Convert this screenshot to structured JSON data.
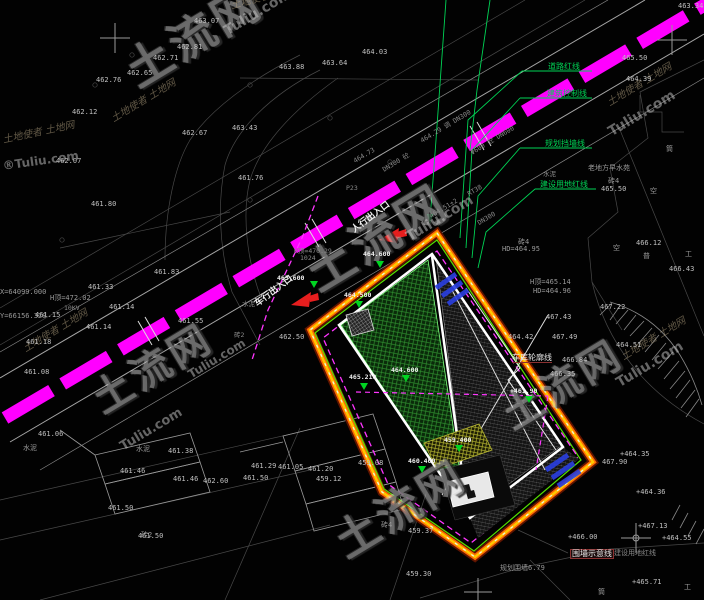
{
  "annotations": {
    "pedestrian_entrance": "人行出入口",
    "vehicle_entrance": "车行出入口",
    "road_red_line": "道路红线",
    "building_control_line": "建筑控制线",
    "planning_wall_line": "规划挡墙线",
    "construction_land_red_line": "建设用地红线",
    "fence_indication_line": "围墙示意线",
    "construction_land_red_line_2": "建设用地红线",
    "garage_outline_line": "车库轮廓线"
  },
  "colors": {
    "road_magenta": "#ff00ff",
    "boundary_glow": "#5f1400",
    "boundary_orange": "#ff6a00",
    "boundary_yellow": "#ffc800",
    "boundary_inner_green": "#55e000",
    "dashed_magenta": "#ff35ff",
    "leader_green": "#00d455",
    "marker_green": "#00d422",
    "arrow_red": "#e61e1e",
    "hatch_green": "#2f8f2f",
    "hatch_gray": "#6a6a6a",
    "hatch_yellow": "#b8b832",
    "blue_mark": "#2a3fe0"
  },
  "green_markers": [
    {
      "t": "463.600",
      "x": 277,
      "y": 274,
      "tx": 310,
      "ty": 281
    },
    {
      "t": "464.600",
      "x": 363,
      "y": 250,
      "tx": 376,
      "ty": 261
    },
    {
      "t": "464.500",
      "x": 344,
      "y": 291,
      "tx": 355,
      "ty": 301
    },
    {
      "t": "465.210",
      "x": 349,
      "y": 373,
      "tx": 360,
      "ty": 383
    },
    {
      "t": "464.600",
      "x": 391,
      "y": 366,
      "tx": 402,
      "ty": 375
    },
    {
      "t": "+461.90",
      "x": 510,
      "y": 387,
      "tx": 525,
      "ty": 396
    },
    {
      "t": "460.400",
      "x": 408,
      "y": 457,
      "tx": 418,
      "ty": 466
    },
    {
      "t": "459.400",
      "x": 444,
      "y": 436,
      "tx": 455,
      "ty": 445
    }
  ],
  "spot_elevations": [
    {
      "t": "463.07",
      "x": 194,
      "y": 17
    },
    {
      "t": "462.81",
      "x": 177,
      "y": 43
    },
    {
      "t": "462.71",
      "x": 153,
      "y": 54
    },
    {
      "t": "462.65",
      "x": 127,
      "y": 69
    },
    {
      "t": "462.76",
      "x": 96,
      "y": 76
    },
    {
      "t": "462.12",
      "x": 72,
      "y": 108
    },
    {
      "t": "462.67",
      "x": 182,
      "y": 129
    },
    {
      "t": "462.07",
      "x": 56,
      "y": 157
    },
    {
      "t": "461.80",
      "x": 91,
      "y": 200
    },
    {
      "t": "464.03",
      "x": 362,
      "y": 48
    },
    {
      "t": "463.64",
      "x": 322,
      "y": 59
    },
    {
      "t": "463.88",
      "x": 279,
      "y": 63
    },
    {
      "t": "463.43",
      "x": 232,
      "y": 124
    },
    {
      "t": "461.76",
      "x": 238,
      "y": 174
    },
    {
      "t": "461.83",
      "x": 154,
      "y": 268
    },
    {
      "t": "461.33",
      "x": 88,
      "y": 283
    },
    {
      "t": "461.14",
      "x": 109,
      "y": 303
    },
    {
      "t": "461.15",
      "x": 35,
      "y": 311
    },
    {
      "t": "461.14",
      "x": 86,
      "y": 323
    },
    {
      "t": "461.18",
      "x": 26,
      "y": 338
    },
    {
      "t": "461.08",
      "x": 24,
      "y": 368
    },
    {
      "t": "461.55",
      "x": 178,
      "y": 317
    },
    {
      "t": "462.50",
      "x": 279,
      "y": 333
    },
    {
      "t": "463.34",
      "x": 678,
      "y": 2
    },
    {
      "t": "465.50",
      "x": 622,
      "y": 54
    },
    {
      "t": "464.39",
      "x": 626,
      "y": 75
    },
    {
      "t": "466.12",
      "x": 636,
      "y": 239
    },
    {
      "t": "466.43",
      "x": 669,
      "y": 265
    },
    {
      "t": "467.22",
      "x": 600,
      "y": 303
    },
    {
      "t": "467.43",
      "x": 546,
      "y": 313
    },
    {
      "t": "467.49",
      "x": 552,
      "y": 333
    },
    {
      "t": "464.51",
      "x": 616,
      "y": 341
    },
    {
      "t": "464.42",
      "x": 508,
      "y": 333
    },
    {
      "t": "466.84",
      "x": 562,
      "y": 356
    },
    {
      "t": "466.35",
      "x": 550,
      "y": 370
    },
    {
      "t": "465.50",
      "x": 601,
      "y": 185
    },
    {
      "t": "+464.35",
      "x": 620,
      "y": 450
    },
    {
      "t": "467.90",
      "x": 602,
      "y": 458
    },
    {
      "t": "+464.36",
      "x": 636,
      "y": 488
    },
    {
      "t": "+467.13",
      "x": 638,
      "y": 522
    },
    {
      "t": "+466.00",
      "x": 568,
      "y": 533
    },
    {
      "t": "+464.55",
      "x": 662,
      "y": 534
    },
    {
      "t": "+465.71",
      "x": 632,
      "y": 578
    },
    {
      "t": "461.29",
      "x": 251,
      "y": 462
    },
    {
      "t": "461.05",
      "x": 278,
      "y": 463
    },
    {
      "t": "461.20",
      "x": 308,
      "y": 465
    },
    {
      "t": "461.50",
      "x": 243,
      "y": 474
    },
    {
      "t": "459.08",
      "x": 358,
      "y": 459
    },
    {
      "t": "459.12",
      "x": 316,
      "y": 475
    },
    {
      "t": "459.37",
      "x": 408,
      "y": 527
    },
    {
      "t": "459.30",
      "x": 406,
      "y": 570
    },
    {
      "t": "461.06",
      "x": 38,
      "y": 430
    },
    {
      "t": "461.46",
      "x": 120,
      "y": 467
    },
    {
      "t": "461.38",
      "x": 168,
      "y": 447
    },
    {
      "t": "461.46",
      "x": 173,
      "y": 475
    },
    {
      "t": "462.60",
      "x": 203,
      "y": 477
    },
    {
      "t": "461.50",
      "x": 108,
      "y": 504
    },
    {
      "t": "461.50",
      "x": 138,
      "y": 532
    }
  ],
  "road_texts": [
    {
      "t": "464.29 调 DN300",
      "x": 418,
      "y": 136,
      "r": -31
    },
    {
      "t": "Φ600 砼 DN600",
      "x": 468,
      "y": 148,
      "r": -31
    },
    {
      "t": "水泥",
      "x": 543,
      "y": 168,
      "r": 0
    },
    {
      "t": "RT38",
      "x": 466,
      "y": 191,
      "r": -31
    },
    {
      "t": "464.51±2",
      "x": 428,
      "y": 213,
      "r": -31
    },
    {
      "t": "DN300",
      "x": 476,
      "y": 220,
      "r": -31
    },
    {
      "t": "DN300 砼",
      "x": 380,
      "y": 165,
      "r": -31
    },
    {
      "t": "464.73",
      "x": 352,
      "y": 158,
      "r": -31
    },
    {
      "t": "P23",
      "x": 346,
      "y": 184,
      "r": 0
    },
    {
      "t": "H顶=470.29",
      "x": 294,
      "y": 245,
      "r": 0
    },
    {
      "t": "1024",
      "x": 300,
      "y": 254,
      "r": 0
    },
    {
      "t": "水泥",
      "x": 242,
      "y": 298,
      "r": 0
    },
    {
      "t": "砖2",
      "x": 234,
      "y": 329,
      "r": 0
    },
    {
      "t": "10KV",
      "x": 64,
      "y": 304,
      "r": 0
    }
  ],
  "misc_texts": [
    {
      "t": "X=64099.000",
      "x": 0,
      "y": 288
    },
    {
      "t": "Y=66156.328",
      "x": 0,
      "y": 312
    },
    {
      "t": "H顶=472.02",
      "x": 50,
      "y": 293
    },
    {
      "t": "砖4",
      "x": 518,
      "y": 237
    },
    {
      "t": "HD=464.95",
      "x": 502,
      "y": 245
    },
    {
      "t": "H顶=465.14",
      "x": 530,
      "y": 277
    },
    {
      "t": "HD=464.96",
      "x": 533,
      "y": 287
    },
    {
      "t": "老地方早水苑",
      "x": 588,
      "y": 163
    },
    {
      "t": "砖4",
      "x": 608,
      "y": 176
    },
    {
      "t": "空",
      "x": 650,
      "y": 186
    },
    {
      "t": "空",
      "x": 613,
      "y": 243
    },
    {
      "t": "普",
      "x": 643,
      "y": 251
    },
    {
      "t": "工",
      "x": 685,
      "y": 249
    },
    {
      "t": "筒",
      "x": 666,
      "y": 144
    },
    {
      "t": "筒",
      "x": 598,
      "y": 587
    },
    {
      "t": "工",
      "x": 684,
      "y": 582
    },
    {
      "t": "规划围墙6.79",
      "x": 500,
      "y": 563
    },
    {
      "t": "砖4",
      "x": 381,
      "y": 520
    },
    {
      "t": "水泥",
      "x": 23,
      "y": 443
    },
    {
      "t": "砖2",
      "x": 141,
      "y": 530
    },
    {
      "t": "水泥",
      "x": 136,
      "y": 444
    }
  ],
  "watermarks": {
    "brand": "土流网",
    "domain": "Tuliu.com",
    "domain_r": "®Tuliu.com",
    "script": "土地使者 土地网",
    "instances": [
      {
        "type": "brand",
        "x": 118,
        "y": 55,
        "r": -31,
        "fs": 46
      },
      {
        "type": "domain",
        "x": 222,
        "y": 26,
        "r": -31,
        "fs": 14
      },
      {
        "type": "brand",
        "x": 298,
        "y": 258,
        "r": -31,
        "fs": 48
      },
      {
        "type": "domain",
        "x": 404,
        "y": 232,
        "r": -31,
        "fs": 14
      },
      {
        "type": "brand",
        "x": 86,
        "y": 386,
        "r": -31,
        "fs": 40
      },
      {
        "type": "domain",
        "x": 118,
        "y": 442,
        "r": -31,
        "fs": 13
      },
      {
        "type": "brand",
        "x": 328,
        "y": 528,
        "r": -31,
        "fs": 44
      },
      {
        "type": "brand",
        "x": 496,
        "y": 402,
        "r": -31,
        "fs": 40
      },
      {
        "type": "domain",
        "x": 606,
        "y": 127,
        "r": -31,
        "fs": 14
      },
      {
        "type": "domain",
        "x": 614,
        "y": 378,
        "r": -31,
        "fs": 14
      },
      {
        "type": "domain",
        "x": 186,
        "y": 370,
        "r": -31,
        "fs": 12
      },
      {
        "type": "domain_r",
        "x": 2,
        "y": 160,
        "r": -8,
        "fs": 12
      },
      {
        "type": "script",
        "x": 2,
        "y": 136,
        "r": -12,
        "fs": 10
      },
      {
        "type": "script",
        "x": 110,
        "y": 116,
        "r": -31,
        "fs": 10
      },
      {
        "type": "script",
        "x": 230,
        "y": 2,
        "r": -15,
        "fs": 10
      },
      {
        "type": "script",
        "x": 606,
        "y": 100,
        "r": -31,
        "fs": 10
      },
      {
        "type": "script",
        "x": 620,
        "y": 354,
        "r": -31,
        "fs": 10
      },
      {
        "type": "script",
        "x": 22,
        "y": 346,
        "r": -31,
        "fs": 10
      }
    ]
  }
}
